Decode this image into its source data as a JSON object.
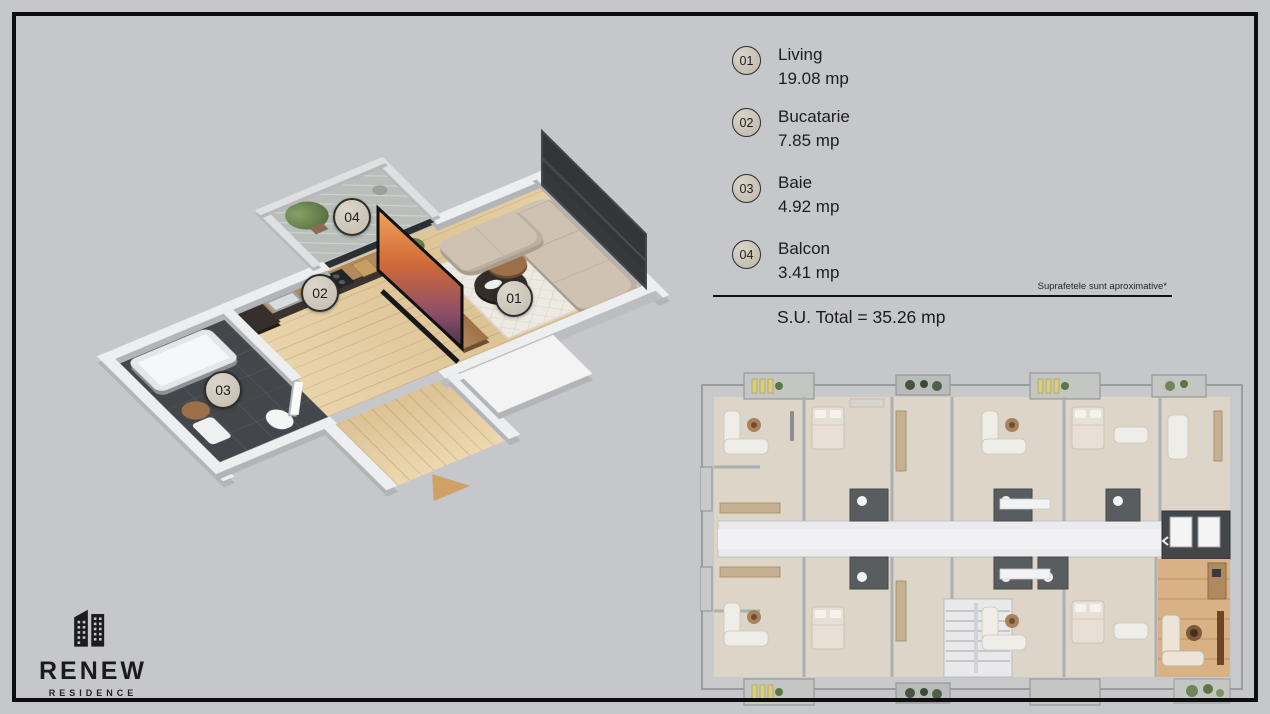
{
  "poster": {
    "background_color": "#c6c7cb",
    "frame_color": "#0e0e10"
  },
  "legend": {
    "items": [
      {
        "id": "01",
        "name": "Living",
        "area": "19.08 mp"
      },
      {
        "id": "02",
        "name": "Bucatarie",
        "area": "7.85 mp"
      },
      {
        "id": "03",
        "name": "Baie",
        "area": "4.92 mp"
      },
      {
        "id": "04",
        "name": "Balcon",
        "area": "3.41 mp"
      }
    ],
    "note": "Suprafetele sunt aproximative*",
    "total": "S.U. Total = 35.26 mp"
  },
  "logo": {
    "name": "RENEW",
    "subtitle": "RESIDENCE"
  },
  "colors": {
    "wood_floor": "#e5cfa3",
    "bathroom_tile": "#43464a",
    "wall_light": "#edeeef",
    "wall_shade": "#b2b4b7",
    "kitchen_cabinet": "#3b342e",
    "counter_wood": "#b28a5e",
    "sofa_beige": "#cfc2b3",
    "console_wood": "#a87c55",
    "rug_white": "#edeae3",
    "balcony_floor": "#b9beba",
    "plant_green": "#5d7545",
    "tv_bezel": "#101011",
    "marker_fill": "#cdc7ba",
    "highlight_unit_wood": "#d8b184",
    "plan_base": "#dcd5c8",
    "plan_wall": "#c7c9cb",
    "plan_bath_dark": "#5a5d60",
    "entry_arrow": "#cfa165"
  }
}
